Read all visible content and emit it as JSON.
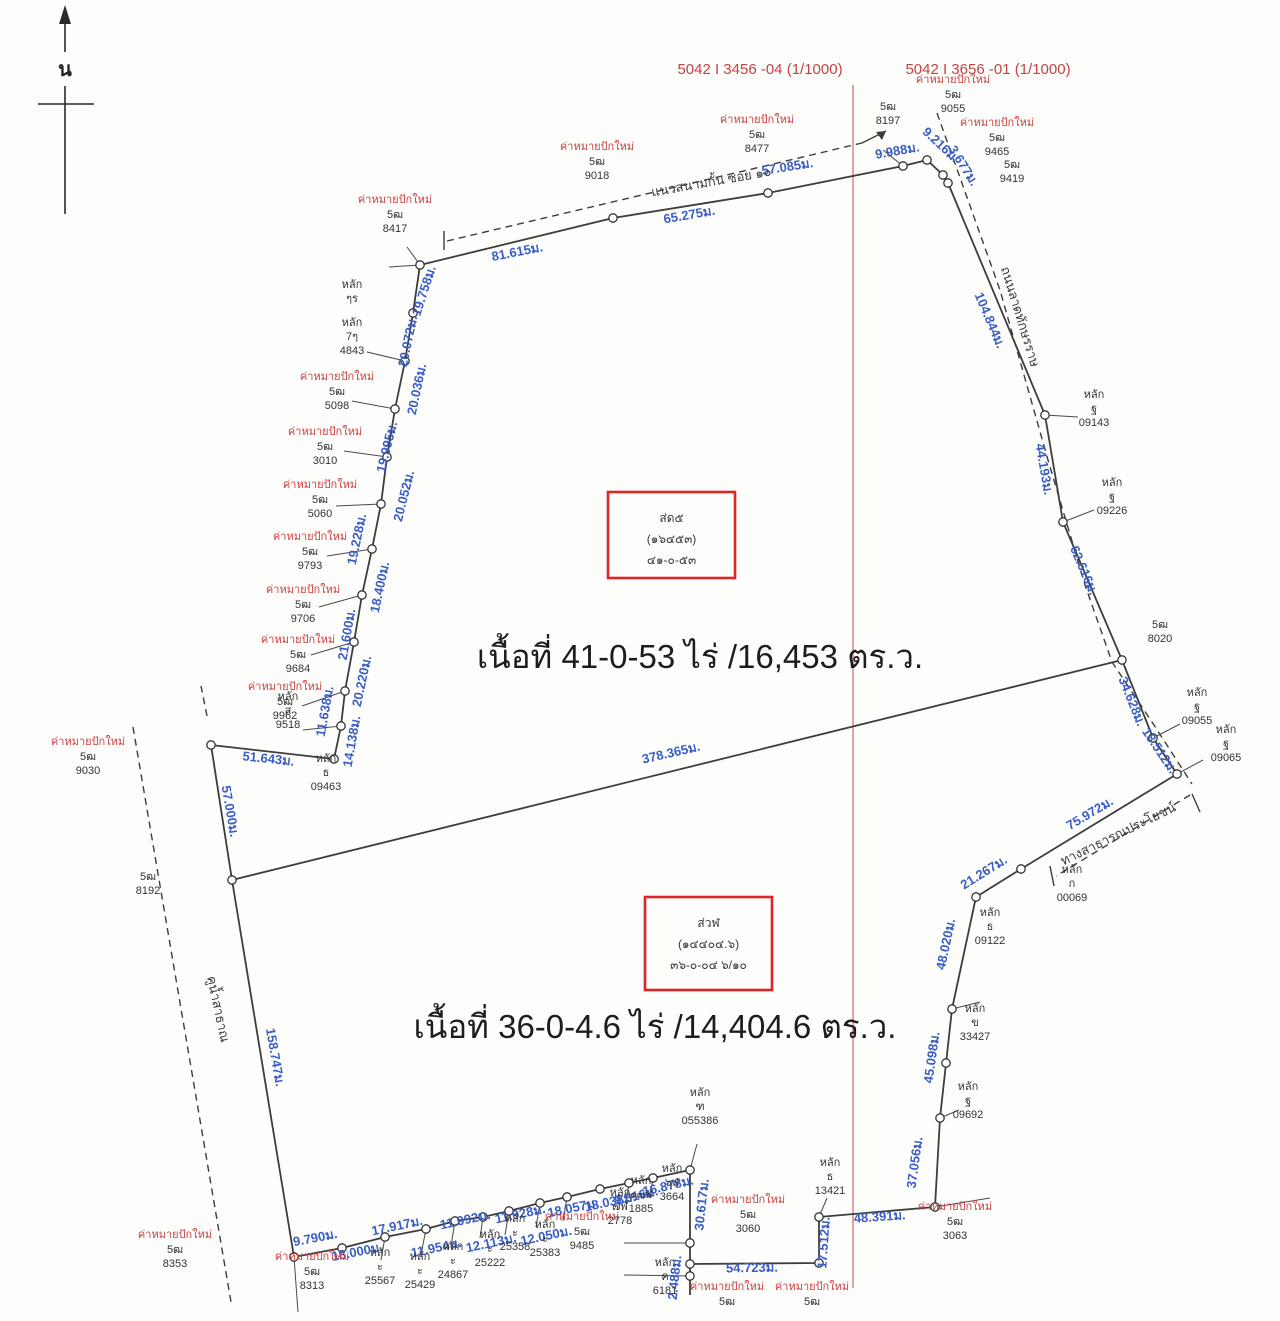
{
  "colors": {
    "measure_blue": "#3b5ec5",
    "marker_red": "#cc4040",
    "sheet_red": "#c34343",
    "divider_red": "#d98c8c",
    "box_red": "#e02424",
    "line_black": "#3d3d3d"
  },
  "north": {
    "label": "น"
  },
  "sheets": [
    {
      "text": "5042 I 3456 -04 (1/1000)",
      "x": 760,
      "y": 74
    },
    {
      "text": "5042 I 3656 -01 (1/1000)",
      "x": 988,
      "y": 74
    }
  ],
  "areas": [
    {
      "text": "เนื้อที่ 41-0-53 ไร่ /16,453 ตร.ว.",
      "x": 700,
      "y": 668
    },
    {
      "text": "เนื้อที่ 36-0-4.6 ไร่ /14,404.6 ตร.ว.",
      "x": 655,
      "y": 1038
    }
  ],
  "parcel_boxes": [
    {
      "x": 608,
      "y": 492,
      "w": 127,
      "h": 86,
      "lines": [
        "ส่ด๕",
        "(๑๖๔๕๓)",
        "๔๑-๐-๕๓"
      ]
    },
    {
      "x": 645,
      "y": 897,
      "w": 127,
      "h": 93,
      "lines": [
        "ส่วฬ",
        "(๑๔๔๐๔.๖)",
        "๓๖-๐-๐๔ ๖/๑๐"
      ]
    }
  ],
  "roads": [
    {
      "text": "แนวสนามกั้น ซอย ๑๐",
      "x": 712,
      "y": 186,
      "r": -10
    },
    {
      "text": "ถนนลาดทักษรราษ",
      "x": 1016,
      "y": 318,
      "r": 73
    },
    {
      "text": "ทางสาธารณประโยชน์",
      "x": 1120,
      "y": 838,
      "r": -26
    },
    {
      "text": "คูน้ำสาธาณ",
      "x": 214,
      "y": 1010,
      "r": 78
    }
  ],
  "measurements": [
    {
      "t": "81.615ม.",
      "x": 518,
      "y": 256,
      "r": -11
    },
    {
      "t": "65.275ม.",
      "x": 690,
      "y": 219,
      "r": -10
    },
    {
      "t": "57.085ม.",
      "x": 788,
      "y": 171,
      "r": -9
    },
    {
      "t": "9.988ม.",
      "x": 898,
      "y": 155,
      "r": -10
    },
    {
      "t": "9.216ม.",
      "x": 938,
      "y": 148,
      "r": 43
    },
    {
      "t": "3.677ม.",
      "x": 960,
      "y": 168,
      "r": 58
    },
    {
      "t": "104.844ม.",
      "x": 986,
      "y": 322,
      "r": 67
    },
    {
      "t": "44.193ม.",
      "x": 1040,
      "y": 470,
      "r": 80
    },
    {
      "t": "62.616ม.",
      "x": 1080,
      "y": 572,
      "r": 67
    },
    {
      "t": "34.628ม.",
      "x": 1128,
      "y": 703,
      "r": 68
    },
    {
      "t": "18.512ม.",
      "x": 1156,
      "y": 753,
      "r": 56
    },
    {
      "t": "19.758ม.",
      "x": 428,
      "y": 292,
      "r": -72
    },
    {
      "t": "20.072ม.",
      "x": 412,
      "y": 342,
      "r": -78
    },
    {
      "t": "20.036ม.",
      "x": 421,
      "y": 390,
      "r": -78
    },
    {
      "t": "19.995ม.",
      "x": 391,
      "y": 448,
      "r": -76
    },
    {
      "t": "20.052ม.",
      "x": 408,
      "y": 497,
      "r": -76
    },
    {
      "t": "19.228ม.",
      "x": 361,
      "y": 540,
      "r": -78
    },
    {
      "t": "18.400ม.",
      "x": 384,
      "y": 588,
      "r": -78
    },
    {
      "t": "21.600ม.",
      "x": 351,
      "y": 635,
      "r": -80
    },
    {
      "t": "20.220ม.",
      "x": 366,
      "y": 682,
      "r": -78
    },
    {
      "t": "11.638ม.",
      "x": 329,
      "y": 712,
      "r": -80
    },
    {
      "t": "14.138ม.",
      "x": 356,
      "y": 742,
      "r": -80
    },
    {
      "t": "51.643ม.",
      "x": 268,
      "y": 763,
      "r": 6
    },
    {
      "t": "57.000ม.",
      "x": 226,
      "y": 812,
      "r": 80
    },
    {
      "t": "378.365ม.",
      "x": 672,
      "y": 757,
      "r": -13
    },
    {
      "t": "158.747ม.",
      "x": 271,
      "y": 1058,
      "r": 80
    },
    {
      "t": "75.972ม.",
      "x": 1092,
      "y": 817,
      "r": -31
    },
    {
      "t": "21.267ม.",
      "x": 986,
      "y": 876,
      "r": -32
    },
    {
      "t": "48.020ม.",
      "x": 950,
      "y": 945,
      "r": -78
    },
    {
      "t": "45.098ม.",
      "x": 936,
      "y": 1058,
      "r": -82
    },
    {
      "t": "37.056ม.",
      "x": 919,
      "y": 1163,
      "r": -82
    },
    {
      "t": "48.391ม.",
      "x": 880,
      "y": 1221,
      "r": -4
    },
    {
      "t": "17.512ม.",
      "x": 828,
      "y": 1243,
      "r": -86
    },
    {
      "t": "54.723ม.",
      "x": 752,
      "y": 1272,
      "r": -1
    },
    {
      "t": "2.488ม.",
      "x": 679,
      "y": 1278,
      "r": -84
    },
    {
      "t": "30.617ม.",
      "x": 706,
      "y": 1205,
      "r": -84
    },
    {
      "t": "9.790ม.",
      "x": 316,
      "y": 1242,
      "r": -11
    },
    {
      "t": "18.000ม.",
      "x": 358,
      "y": 1256,
      "r": -11
    },
    {
      "t": "17.917ม.",
      "x": 398,
      "y": 1230,
      "r": -12
    },
    {
      "t": "11.954ม.",
      "x": 437,
      "y": 1252,
      "r": -12
    },
    {
      "t": "11.992ม.",
      "x": 466,
      "y": 1224,
      "r": -12
    },
    {
      "t": "12.113ม.",
      "x": 492,
      "y": 1247,
      "r": -12
    },
    {
      "t": "11.928ม.",
      "x": 521,
      "y": 1218,
      "r": -12
    },
    {
      "t": "12.050ม.",
      "x": 547,
      "y": 1240,
      "r": -12
    },
    {
      "t": "18.057ม.",
      "x": 574,
      "y": 1212,
      "r": -12
    },
    {
      "t": "18.038ม.",
      "x": 611,
      "y": 1206,
      "r": -12
    },
    {
      "t": "9.816ม.",
      "x": 637,
      "y": 1200,
      "r": -13
    },
    {
      "t": "16.878ม.",
      "x": 669,
      "y": 1190,
      "r": -13
    }
  ],
  "red_markers": {
    "label": "ค่าหมายปักใหม่",
    "code": "5ฒ",
    "items": [
      {
        "x": 395,
        "y": 203,
        "num": "8417"
      },
      {
        "x": 597,
        "y": 150,
        "num": "9018"
      },
      {
        "x": 757,
        "y": 123,
        "num": "8477"
      },
      {
        "x": 953,
        "y": 83,
        "num": "9055"
      },
      {
        "x": 997,
        "y": 126,
        "num": "9465"
      },
      {
        "x": 337,
        "y": 380,
        "num": "5098"
      },
      {
        "x": 325,
        "y": 435,
        "num": "3010"
      },
      {
        "x": 320,
        "y": 488,
        "num": "5060"
      },
      {
        "x": 310,
        "y": 540,
        "num": "9793"
      },
      {
        "x": 303,
        "y": 593,
        "num": "9706"
      },
      {
        "x": 298,
        "y": 643,
        "num": "9684"
      },
      {
        "x": 285,
        "y": 690,
        "num": "9962"
      },
      {
        "x": 88,
        "y": 745,
        "num": "9030"
      },
      {
        "x": 175,
        "y": 1238,
        "num": "8353"
      },
      {
        "x": 312,
        "y": 1260,
        "num": "8313"
      },
      {
        "x": 582,
        "y": 1220,
        "num": "9485"
      },
      {
        "x": 748,
        "y": 1203,
        "num": "3060"
      },
      {
        "x": 955,
        "y": 1210,
        "num": "3063"
      },
      {
        "x": 727,
        "y": 1290,
        "num": ""
      },
      {
        "x": 812,
        "y": 1290,
        "num": ""
      }
    ]
  },
  "black_markers": [
    {
      "x": 352,
      "y": 288,
      "lines": [
        "หลัก",
        "ๆร"
      ]
    },
    {
      "x": 352,
      "y": 326,
      "lines": [
        "หลัก",
        "7ๆ",
        "4843"
      ]
    },
    {
      "x": 288,
      "y": 700,
      "lines": [
        "หลัก",
        "ส",
        "9518"
      ]
    },
    {
      "x": 326,
      "y": 762,
      "lines": [
        "หลัก",
        "ธ",
        "09463"
      ]
    },
    {
      "x": 148,
      "y": 880,
      "lines": [
        "5ฒ",
        "8192"
      ]
    },
    {
      "x": 888,
      "y": 110,
      "lines": [
        "5ฒ",
        "8197"
      ]
    },
    {
      "x": 1012,
      "y": 168,
      "lines": [
        "5ฒ",
        "9419"
      ]
    },
    {
      "x": 1094,
      "y": 398,
      "lines": [
        "หลัก",
        "ฐ",
        "09143"
      ]
    },
    {
      "x": 1112,
      "y": 486,
      "lines": [
        "หลัก",
        "ฐ",
        "09226"
      ]
    },
    {
      "x": 1160,
      "y": 628,
      "lines": [
        "5ฒ",
        "8020"
      ]
    },
    {
      "x": 1197,
      "y": 696,
      "lines": [
        "หลัก",
        "ฐ",
        "09055"
      ]
    },
    {
      "x": 1226,
      "y": 733,
      "lines": [
        "หลัก",
        "ฐ",
        "09065"
      ]
    },
    {
      "x": 1072,
      "y": 873,
      "lines": [
        "หลัก",
        "ก",
        "00069"
      ]
    },
    {
      "x": 990,
      "y": 916,
      "lines": [
        "หลัก",
        "ธ",
        "09122"
      ]
    },
    {
      "x": 975,
      "y": 1012,
      "lines": [
        "หลัก",
        "ข",
        "33427"
      ]
    },
    {
      "x": 968,
      "y": 1090,
      "lines": [
        "หลัก",
        "ฐ",
        "09692"
      ]
    },
    {
      "x": 830,
      "y": 1166,
      "lines": [
        "หลัก",
        "ธ",
        "13421"
      ]
    },
    {
      "x": 700,
      "y": 1096,
      "lines": [
        "หลัก",
        "ฑ",
        "055386"
      ]
    },
    {
      "x": 665,
      "y": 1266,
      "lines": [
        "หลัก",
        "ค",
        "6181"
      ]
    },
    {
      "x": 380,
      "y": 1256,
      "lines": [
        "หลัก",
        "ะ",
        "25567"
      ]
    },
    {
      "x": 420,
      "y": 1260,
      "lines": [
        "หลัก",
        "ะ",
        "25429"
      ]
    },
    {
      "x": 453,
      "y": 1250,
      "lines": [
        "หลัก",
        "ะ",
        "24867"
      ]
    },
    {
      "x": 490,
      "y": 1238,
      "lines": [
        "หลัก",
        "ะ",
        "25222"
      ]
    },
    {
      "x": 515,
      "y": 1222,
      "lines": [
        "หลัก",
        "ะ",
        "25358"
      ]
    },
    {
      "x": 545,
      "y": 1228,
      "lines": [
        "หลัก",
        "ะ",
        "25383"
      ]
    },
    {
      "x": 620,
      "y": 1196,
      "lines": [
        "หลัก",
        "๗ฬ",
        "2778"
      ]
    },
    {
      "x": 641,
      "y": 1184,
      "lines": [
        "หลัก",
        "๑๗ฬ",
        "1885"
      ]
    },
    {
      "x": 672,
      "y": 1172,
      "lines": [
        "หลัก",
        "๖ฬ",
        "3664"
      ]
    }
  ]
}
